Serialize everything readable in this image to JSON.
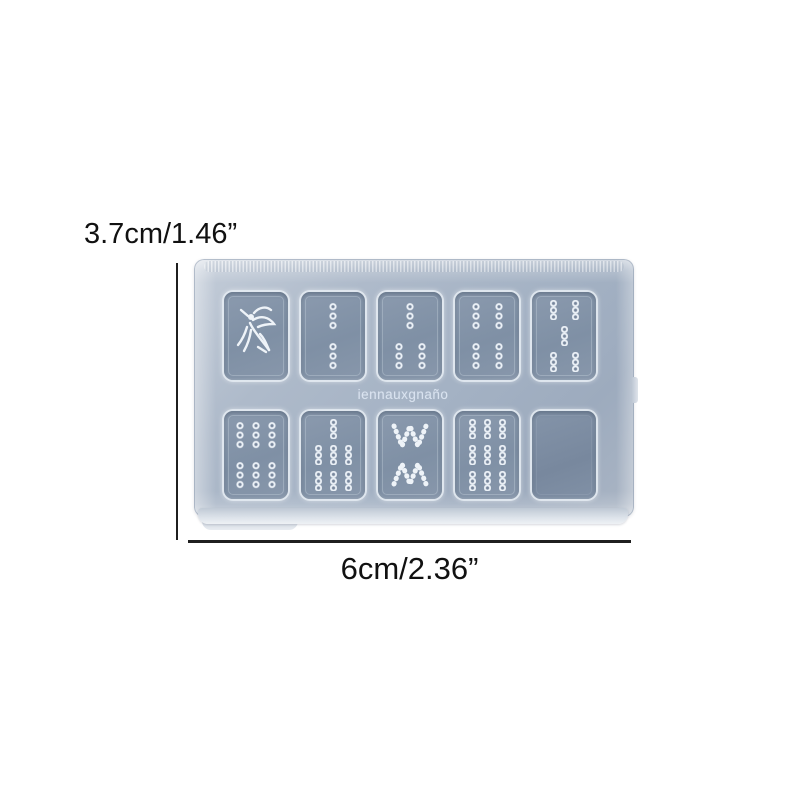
{
  "image_type": "product photo of a silicone resin mold with dimension annotations",
  "annotations": {
    "height_label": "3.7cm/1.46”",
    "width_label": "6cm/2.36”"
  },
  "mold": {
    "watermark": "iennauxgnaño",
    "rows": 2,
    "columns": 5,
    "tiles": [
      {
        "id": "1-bamboo-bird",
        "kind": "bird",
        "label": "mahjong 1 bamboo (sparrow)"
      },
      {
        "id": "2-bamboo",
        "kind": "sticks",
        "rows": [
          1,
          1
        ],
        "label": "mahjong 2 bamboo"
      },
      {
        "id": "3-bamboo",
        "kind": "sticks",
        "rows": [
          1,
          2
        ],
        "label": "mahjong 3 bamboo"
      },
      {
        "id": "4-bamboo",
        "kind": "sticks",
        "rows": [
          2,
          2
        ],
        "label": "mahjong 4 bamboo"
      },
      {
        "id": "5-bamboo",
        "kind": "sticks",
        "rows": [
          2,
          1,
          2
        ],
        "label": "mahjong 5 bamboo"
      },
      {
        "id": "6-bamboo",
        "kind": "sticks",
        "rows": [
          3,
          3
        ],
        "label": "mahjong 6 bamboo"
      },
      {
        "id": "7-bamboo",
        "kind": "sticks",
        "rows": [
          1,
          3,
          3
        ],
        "label": "mahjong 7 bamboo"
      },
      {
        "id": "8-bamboo",
        "kind": "chevrons",
        "label": "mahjong 8 bamboo"
      },
      {
        "id": "9-bamboo",
        "kind": "sticks",
        "rows": [
          3,
          3,
          3
        ],
        "label": "mahjong 9 bamboo"
      },
      {
        "id": "blank-tile",
        "kind": "blank",
        "label": "blank cavity"
      }
    ]
  },
  "colors": {
    "background": "#ffffff",
    "dimension_line": "#1f1f1f",
    "label_text": "#111111",
    "mold_body": "#aab6c6",
    "cavity": "#8191a6",
    "engraving": "#eef3f8"
  }
}
